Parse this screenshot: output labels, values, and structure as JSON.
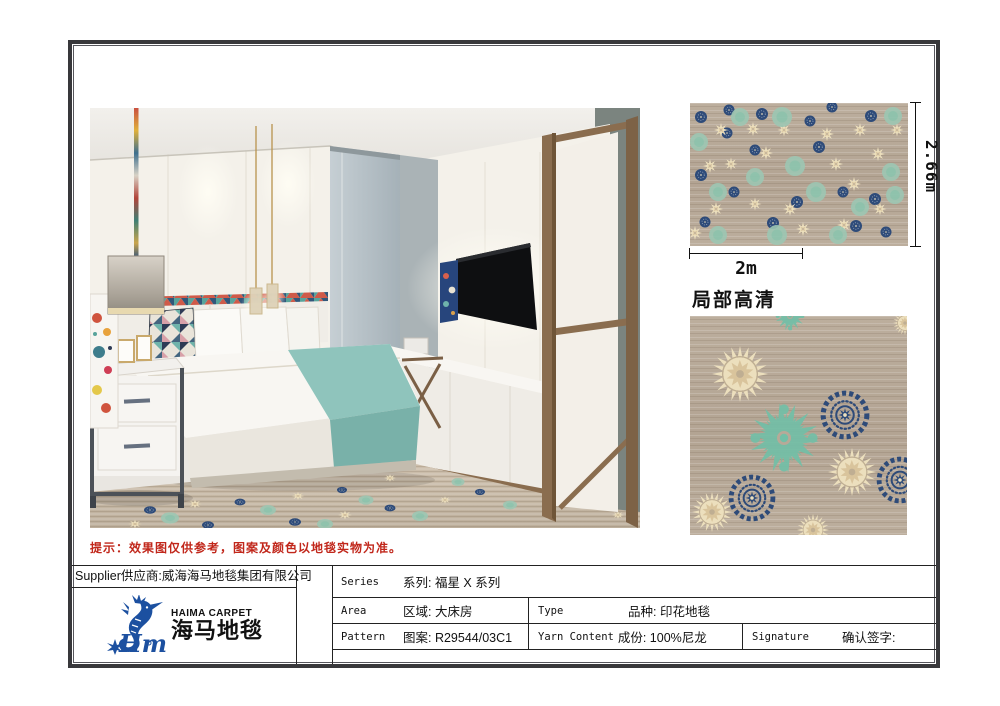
{
  "document": {
    "note": "提示：效果图仅供参考，图案及颜色以地毯实物为准。",
    "closeup_title": "局部高清",
    "dim_width": "2m",
    "dim_height": "2.66m"
  },
  "supplier": {
    "label": "Supplier",
    "value": "供应商:威海海马地毯集团有限公司"
  },
  "logo": {
    "brand_en": "HAIMA CARPET",
    "brand_cn": "海马地毯",
    "script": "Hm",
    "color": "#1c50a0"
  },
  "spec_table": {
    "series_en": "Series",
    "series_cn": "系列: 福星 X 系列",
    "area_en": "Area",
    "area_cn": "区域: 大床房",
    "pattern_en": "Pattern",
    "pattern_cn": "图案: R29544/03C1",
    "type_en": "Type",
    "type_cn": "品种: 印花地毯",
    "yarn_en": "Yarn Content",
    "yarn_cn": "成份: 100%尼龙",
    "signature_en": "Signature",
    "signature_cn": "确认签字:"
  },
  "palette": {
    "navy": "#2e4b79",
    "cream": "#ecdfbd",
    "cream_dark": "#d9c49c",
    "teal": "#72bfa7",
    "teal_soft": "#9cc7b2",
    "taupe": "#b7a998",
    "note_red": "#c1271b",
    "frame_dark": "#38383b",
    "wood": "#8a6d4f",
    "runner_teal": "#8fc4bc",
    "glass_blue": "#b6c0c6"
  },
  "carpet_pattern": {
    "swatch": [
      [
        "n",
        11,
        14,
        6
      ],
      [
        "n",
        39,
        7,
        5.5
      ],
      [
        "n",
        72,
        11,
        6
      ],
      [
        "n",
        142,
        4,
        5.5
      ],
      [
        "n",
        181,
        13,
        6
      ],
      [
        "n",
        37,
        30,
        5.5
      ],
      [
        "n",
        129,
        44,
        6
      ],
      [
        "n",
        65,
        47,
        5.5
      ],
      [
        "n",
        11,
        72,
        6
      ],
      [
        "n",
        107,
        99,
        6
      ],
      [
        "n",
        153,
        89,
        5.5
      ],
      [
        "n",
        185,
        96,
        6
      ],
      [
        "n",
        44,
        89,
        5.5
      ],
      [
        "n",
        83,
        120,
        6
      ],
      [
        "n",
        15,
        119,
        5.5
      ],
      [
        "n",
        166,
        123,
        6
      ],
      [
        "n",
        196,
        129,
        5.5
      ],
      [
        "n",
        120,
        18,
        5.5
      ],
      [
        "c",
        31,
        27,
        7
      ],
      [
        "c",
        63,
        26,
        7
      ],
      [
        "c",
        76,
        50,
        7
      ],
      [
        "c",
        137,
        31,
        7
      ],
      [
        "c",
        170,
        27,
        7
      ],
      [
        "c",
        188,
        51,
        7
      ],
      [
        "c",
        94,
        27,
        6.5
      ],
      [
        "c",
        20,
        63,
        7
      ],
      [
        "c",
        41,
        61,
        6.5
      ],
      [
        "c",
        146,
        61,
        7
      ],
      [
        "c",
        164,
        81,
        7
      ],
      [
        "c",
        100,
        106,
        7
      ],
      [
        "c",
        26,
        106,
        7
      ],
      [
        "c",
        65,
        101,
        6.5
      ],
      [
        "c",
        5,
        130,
        7
      ],
      [
        "c",
        113,
        126,
        7
      ],
      [
        "c",
        190,
        106,
        6.5
      ],
      [
        "c",
        207,
        27,
        6.5
      ],
      [
        "c",
        154,
        122,
        7
      ],
      [
        "t",
        92,
        14,
        10
      ],
      [
        "t",
        203,
        13,
        9
      ],
      [
        "t",
        9,
        39,
        9
      ],
      [
        "t",
        105,
        63,
        10
      ],
      [
        "t",
        201,
        69,
        9
      ],
      [
        "t",
        28,
        89,
        9
      ],
      [
        "t",
        126,
        89,
        10
      ],
      [
        "t",
        65,
        74,
        9
      ],
      [
        "t",
        170,
        104,
        9
      ],
      [
        "t",
        87,
        132,
        10
      ],
      [
        "t",
        28,
        132,
        9
      ],
      [
        "t",
        148,
        132,
        9
      ],
      [
        "t",
        205,
        92,
        9
      ],
      [
        "t",
        50,
        14,
        9
      ]
    ],
    "closeup": [
      [
        "d",
        94,
        122,
        35
      ],
      [
        "d",
        100,
        0,
        15
      ],
      [
        "s",
        50,
        58,
        28
      ],
      [
        "s",
        162,
        156,
        24
      ],
      [
        "s",
        22,
        196,
        20
      ],
      [
        "s",
        215,
        7,
        12
      ],
      [
        "s",
        123,
        214,
        16
      ],
      [
        "m",
        155,
        99,
        23
      ],
      [
        "m",
        62,
        182,
        22
      ],
      [
        "m",
        210,
        164,
        22
      ]
    ],
    "render_floor": [
      [
        "n",
        60,
        402,
        6
      ],
      [
        "c",
        105,
        396,
        7
      ],
      [
        "t",
        80,
        410,
        9
      ],
      [
        "n",
        150,
        394,
        5.5
      ],
      [
        "c",
        208,
        388,
        6.5
      ],
      [
        "t",
        178,
        402,
        8
      ],
      [
        "n",
        252,
        382,
        5
      ],
      [
        "c",
        300,
        370,
        6
      ],
      [
        "t",
        276,
        392,
        7.5
      ],
      [
        "n",
        345,
        356,
        4.5
      ],
      [
        "c",
        390,
        362,
        5.5
      ],
      [
        "t",
        368,
        374,
        6.5
      ],
      [
        "n",
        432,
        352,
        4.5
      ],
      [
        "c",
        470,
        356,
        5
      ],
      [
        "t",
        452,
        364,
        6
      ],
      [
        "n",
        505,
        348,
        4
      ],
      [
        "c",
        540,
        362,
        5
      ],
      [
        "t",
        528,
        377,
        6.5
      ],
      [
        "n",
        205,
        414,
        6
      ],
      [
        "c",
        255,
        407,
        7
      ],
      [
        "t",
        330,
        408,
        8
      ],
      [
        "n",
        300,
        400,
        5.5
      ],
      [
        "c",
        355,
        392,
        6
      ],
      [
        "n",
        390,
        384,
        5
      ],
      [
        "t",
        420,
        397,
        7
      ],
      [
        "c",
        445,
        380,
        5.5
      ],
      [
        "n",
        480,
        372,
        4.5
      ],
      [
        "t",
        500,
        387,
        6.5
      ],
      [
        "c",
        45,
        416,
        7
      ],
      [
        "n",
        118,
        417,
        6
      ],
      [
        "t",
        235,
        416,
        8
      ],
      [
        "c",
        528,
        407,
        6
      ],
      [
        "n",
        545,
        394,
        5
      ]
    ]
  }
}
